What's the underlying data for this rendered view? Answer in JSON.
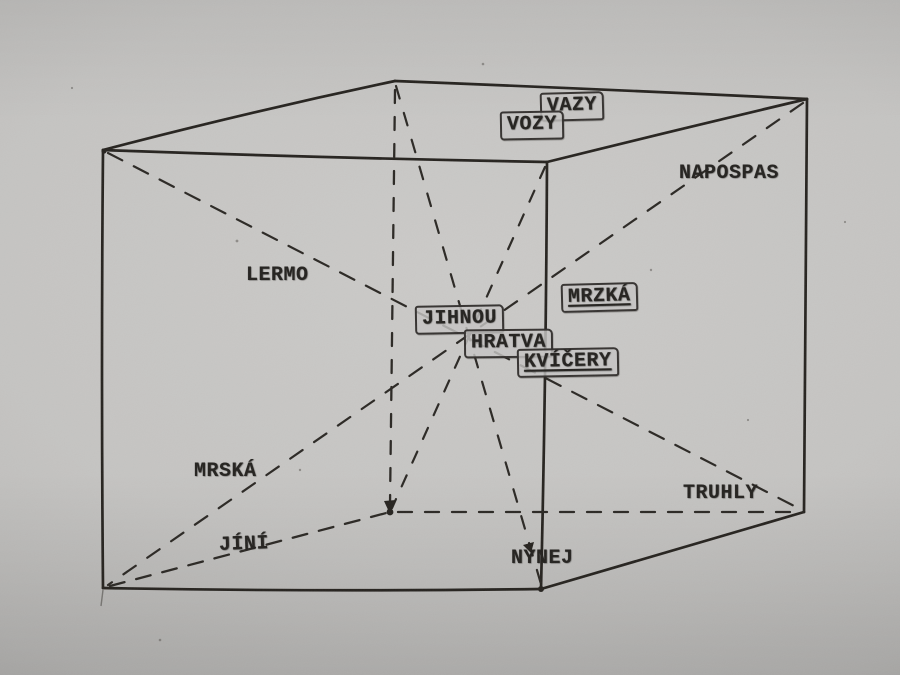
{
  "diagram": {
    "labels": [
      {
        "id": "vazy",
        "text": "VAZY",
        "boxed": true,
        "underlined": false
      },
      {
        "id": "vozy",
        "text": "VOZY",
        "boxed": true,
        "underlined": false
      },
      {
        "id": "napospas",
        "text": "NAPOSPAS",
        "boxed": false,
        "underlined": false
      },
      {
        "id": "lermo",
        "text": "LERMO",
        "boxed": false,
        "underlined": false
      },
      {
        "id": "mrzka",
        "text": "MRZKÁ",
        "boxed": true,
        "underlined": true
      },
      {
        "id": "jihnou",
        "text": "JIHNOU",
        "boxed": true,
        "underlined": false
      },
      {
        "id": "hratva",
        "text": "HRATVA",
        "boxed": true,
        "underlined": false
      },
      {
        "id": "kvicery",
        "text": "KVÍČERY",
        "boxed": true,
        "underlined": true
      },
      {
        "id": "mrska",
        "text": "MRSKÁ",
        "boxed": false,
        "underlined": false
      },
      {
        "id": "truhly",
        "text": "TRUHLY",
        "boxed": false,
        "underlined": false
      },
      {
        "id": "jini",
        "text": "JÍNÍ",
        "boxed": false,
        "underlined": false
      },
      {
        "id": "nynej",
        "text": "NYNEJ",
        "boxed": false,
        "underlined": false
      }
    ],
    "colors": {
      "paper": "#c5c4c2",
      "ink": "#24221f"
    }
  }
}
